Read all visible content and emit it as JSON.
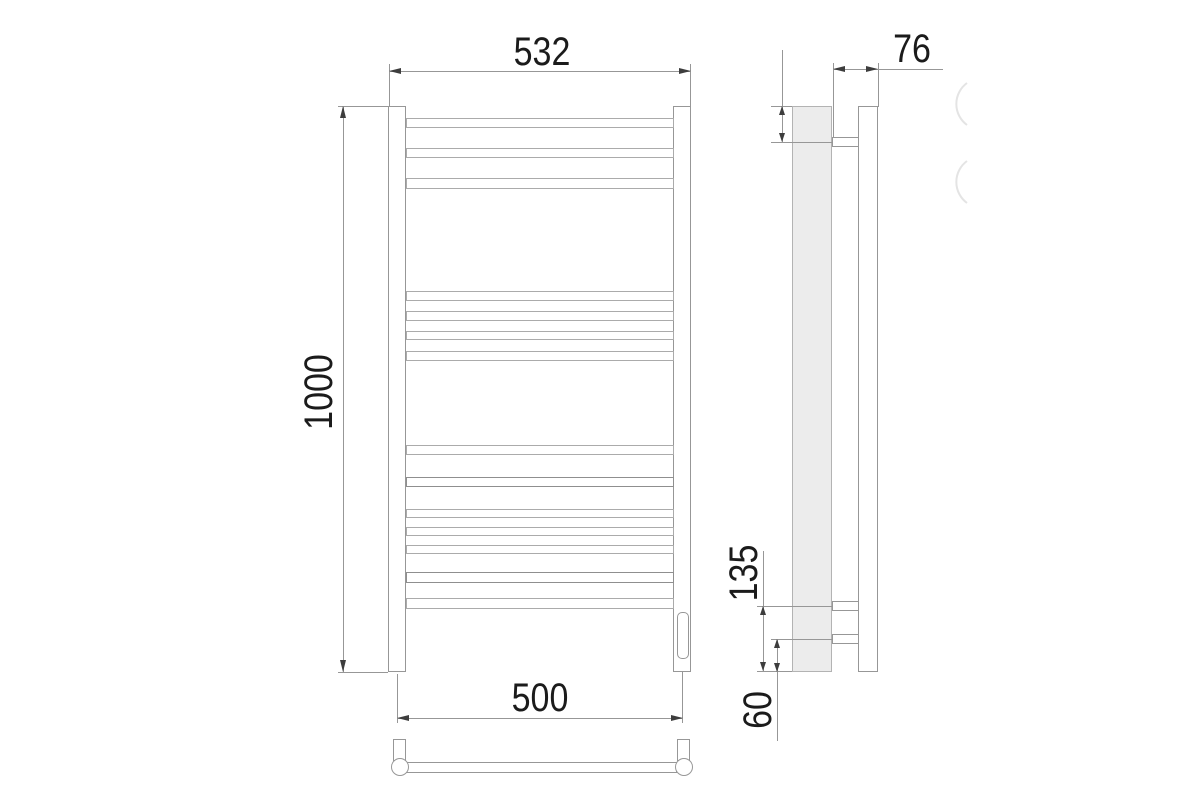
{
  "drawing_type": "towel-rail-technical-drawing",
  "dimensions": {
    "front": {
      "width_top": "532",
      "height": "1000",
      "axle_width_bottom": "500"
    },
    "side": {
      "depth": "76",
      "top_bracket_offset": "60",
      "bottom_bracket_span": "135",
      "bottom_bracket_offset": "60"
    }
  },
  "colors": {
    "line": "#979797",
    "text": "#1b1b1b",
    "profile_fill": "#ececec",
    "watermark": "#e4e4e4"
  }
}
